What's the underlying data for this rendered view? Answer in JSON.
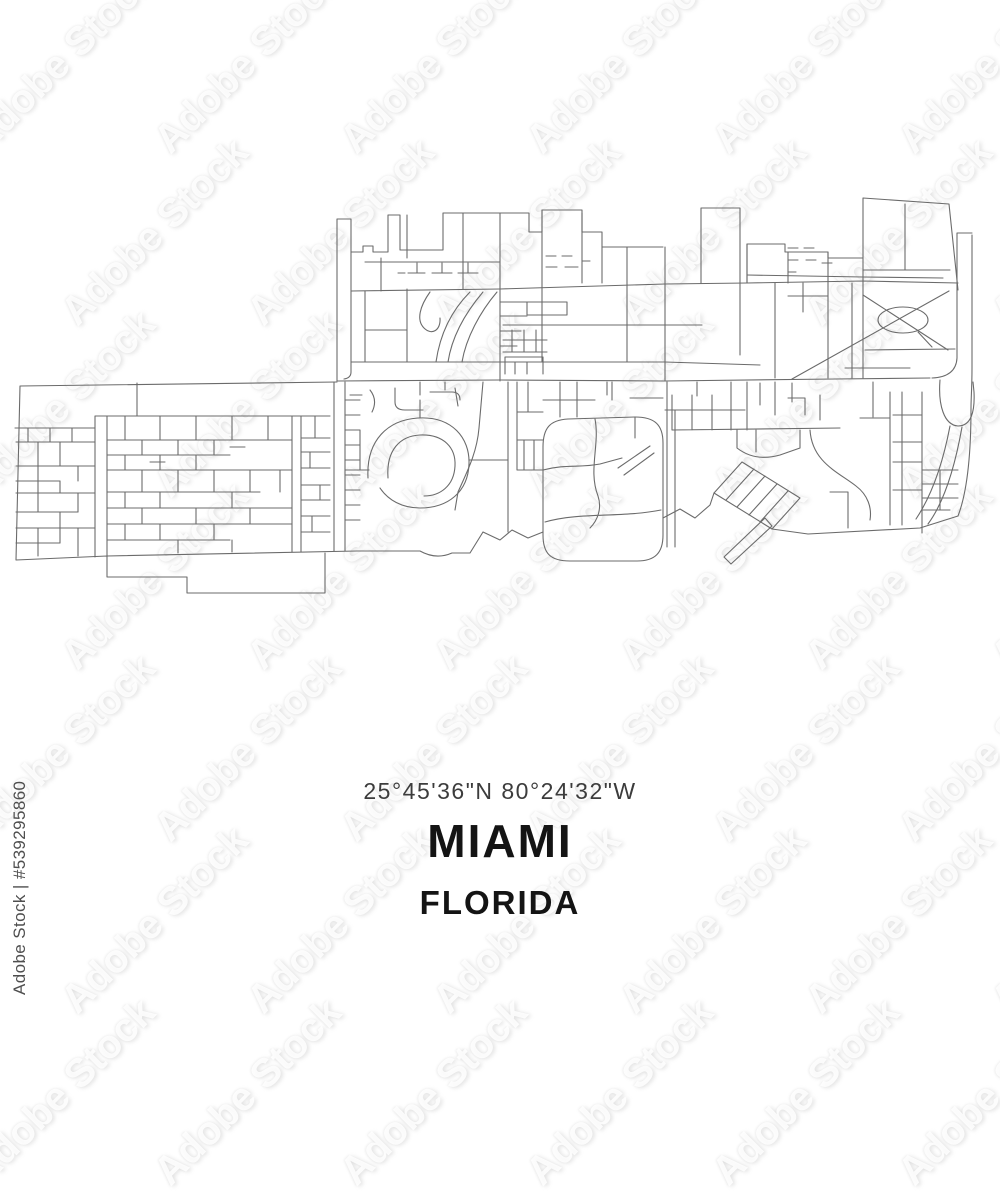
{
  "poster": {
    "coordinates": "25°45'36\"N 80°24'32\"W",
    "city": "MIAMI",
    "state": "FLORIDA"
  },
  "watermark": {
    "brand": "Adobe Stock",
    "license_id": "Adobe Stock | #539295860"
  },
  "map": {
    "name": "miami-florida-street-map",
    "line_color": "#6b6b6b",
    "background": "#ffffff"
  }
}
